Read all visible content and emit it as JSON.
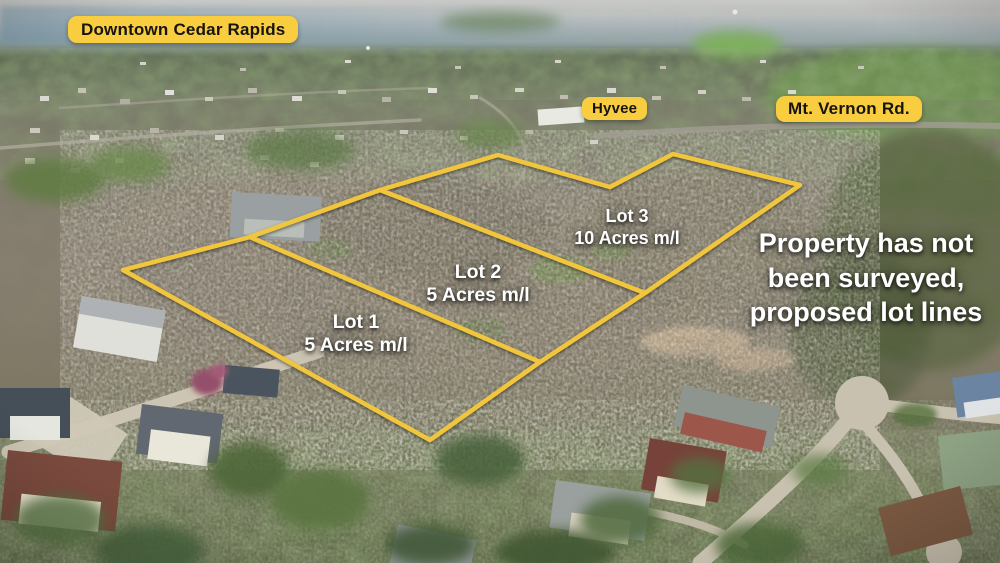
{
  "scene": {
    "type": "aerial-drone-photo",
    "caption_badges": [
      {
        "label": "Downtown Cedar Rapids"
      },
      {
        "label": "Hyvee"
      },
      {
        "label": "Mt. Vernon Rd."
      }
    ]
  },
  "lots": [
    {
      "name": "Lot 1",
      "size": "5 Acres m/l"
    },
    {
      "name": "Lot 2",
      "size": "5 Acres m/l"
    },
    {
      "name": "Lot 3",
      "size": "10 Acres m/l"
    }
  ],
  "disclaimer": {
    "lines": [
      "Property has not",
      "been surveyed,",
      "proposed lot lines"
    ]
  },
  "colors": {
    "badge_bg": "#F8CD40",
    "badge_text": "#171410",
    "lot_line": "#F1C63C",
    "label_text": "#FFFFFF"
  },
  "lot_lines": {
    "color": "#F1C63C",
    "stroke_width": 4.5,
    "outer": [
      [
        123,
        270
      ],
      [
        250,
        237
      ],
      [
        380,
        190
      ],
      [
        498,
        155
      ],
      [
        610,
        187
      ],
      [
        673,
        154
      ],
      [
        800,
        185
      ],
      [
        645,
        293
      ],
      [
        540,
        362
      ],
      [
        430,
        440
      ]
    ],
    "dividers": [
      [
        [
          250,
          237
        ],
        [
          540,
          362
        ]
      ],
      [
        [
          380,
          190
        ],
        [
          645,
          293
        ]
      ]
    ]
  }
}
